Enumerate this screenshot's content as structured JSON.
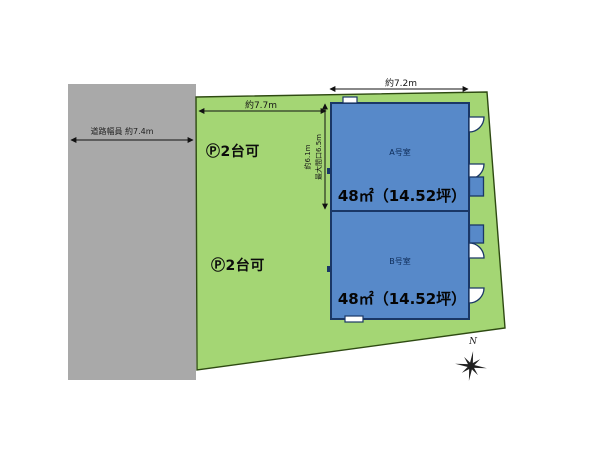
{
  "road": {
    "width_label": "道路幅員 約7.4m"
  },
  "dimensions": {
    "lot_frontage_top": "約7.7m",
    "building_width_top": "約7.2m",
    "building_depth_line1": "約6.1m",
    "building_depth_line2": "最大間口6.5m"
  },
  "parking": {
    "upper_label": "Ⓟ2台可",
    "lower_label": "Ⓟ2台可"
  },
  "units": [
    {
      "name": "A号室",
      "area": "48㎡（14.52坪）"
    },
    {
      "name": "B号室",
      "area": "48㎡（14.52坪）"
    }
  ],
  "compass": {
    "north_label": "N"
  },
  "colors": {
    "lot_green": "#a4d674",
    "lot_outline": "#2e4a12",
    "building_blue": "#5789c9",
    "building_outline": "#1a3766",
    "road_gray": "#a9a9a9",
    "annotation_black": "#111111"
  }
}
